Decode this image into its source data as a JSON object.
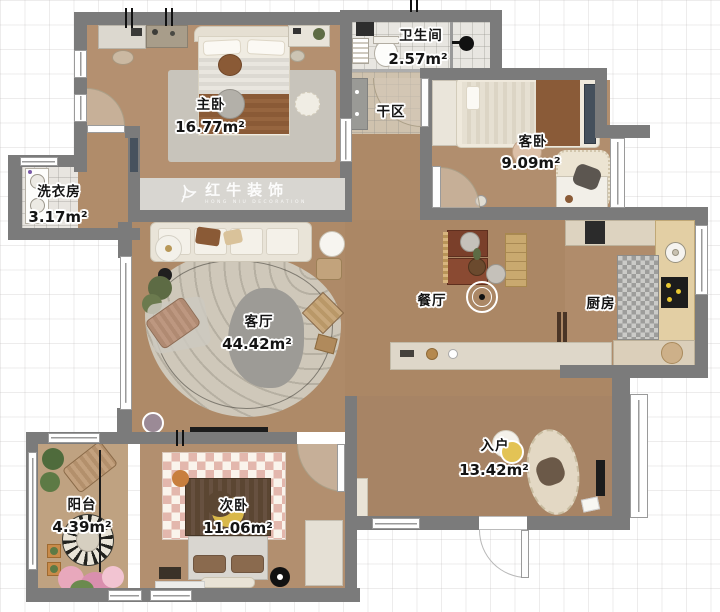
{
  "meta": {
    "plan_width_px": 720,
    "plan_height_px": 612,
    "units": "m²"
  },
  "watermark": {
    "logo": "bull-icon",
    "title": "红牛装饰",
    "subtitle": "HONG NIU DECORATION"
  },
  "rooms": [
    {
      "id": "master",
      "label": "主卧",
      "area": "16.77m²"
    },
    {
      "id": "laundry",
      "label": "洗衣房",
      "area": "3.17m²"
    },
    {
      "id": "bathroom",
      "label": "卫生间",
      "area": "2.57m²"
    },
    {
      "id": "dryzone",
      "label": "干区",
      "area": ""
    },
    {
      "id": "guest",
      "label": "客卧",
      "area": "9.09m²"
    },
    {
      "id": "kitchen",
      "label": "厨房",
      "area": ""
    },
    {
      "id": "dining",
      "label": "餐厅",
      "area": ""
    },
    {
      "id": "living",
      "label": "客厅",
      "area": "44.42m²"
    },
    {
      "id": "balcony",
      "label": "阳台",
      "area": "4.39m²"
    },
    {
      "id": "second",
      "label": "次卧",
      "area": "11.06m²"
    },
    {
      "id": "entry",
      "label": "入户",
      "area": "13.42m²"
    }
  ],
  "colors": {
    "wall": "#7b7b7b",
    "wood_floor": "#ae8a68",
    "master_floor": "#b49070",
    "balcony_floor": "#bfa281",
    "tile_floor": "#e8e6e1",
    "wardrobe_band": "#d8d6d1",
    "rug_living": "#cfc8ba",
    "accent_yellow": "#e3c355",
    "accent_brown": "#8a5a36"
  }
}
